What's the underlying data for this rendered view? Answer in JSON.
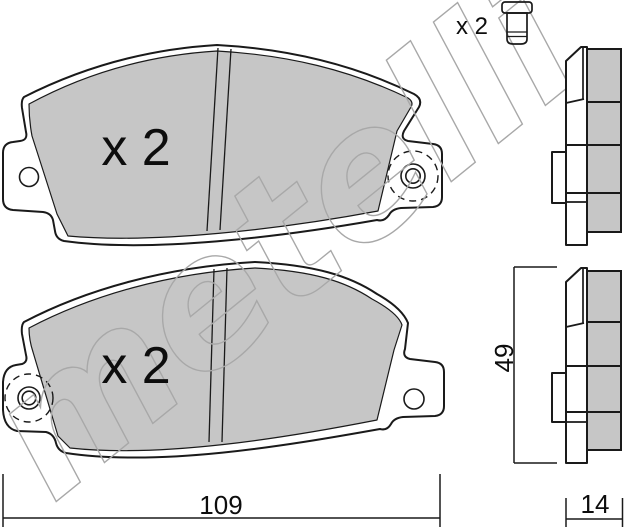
{
  "watermark": {
    "text": "metelli"
  },
  "colors": {
    "pad_fill": "#c6c6c6",
    "outline": "#1a1a1a",
    "watermark": "#a8a8a8",
    "background": "#ffffff"
  },
  "views": {
    "front_top": {
      "quantity": "x 2"
    },
    "front_bottom": {
      "quantity": "x 2"
    },
    "rivet": {
      "quantity": "x 2"
    }
  },
  "dimensions": {
    "length": "109",
    "thickness": "14",
    "height": "49"
  }
}
